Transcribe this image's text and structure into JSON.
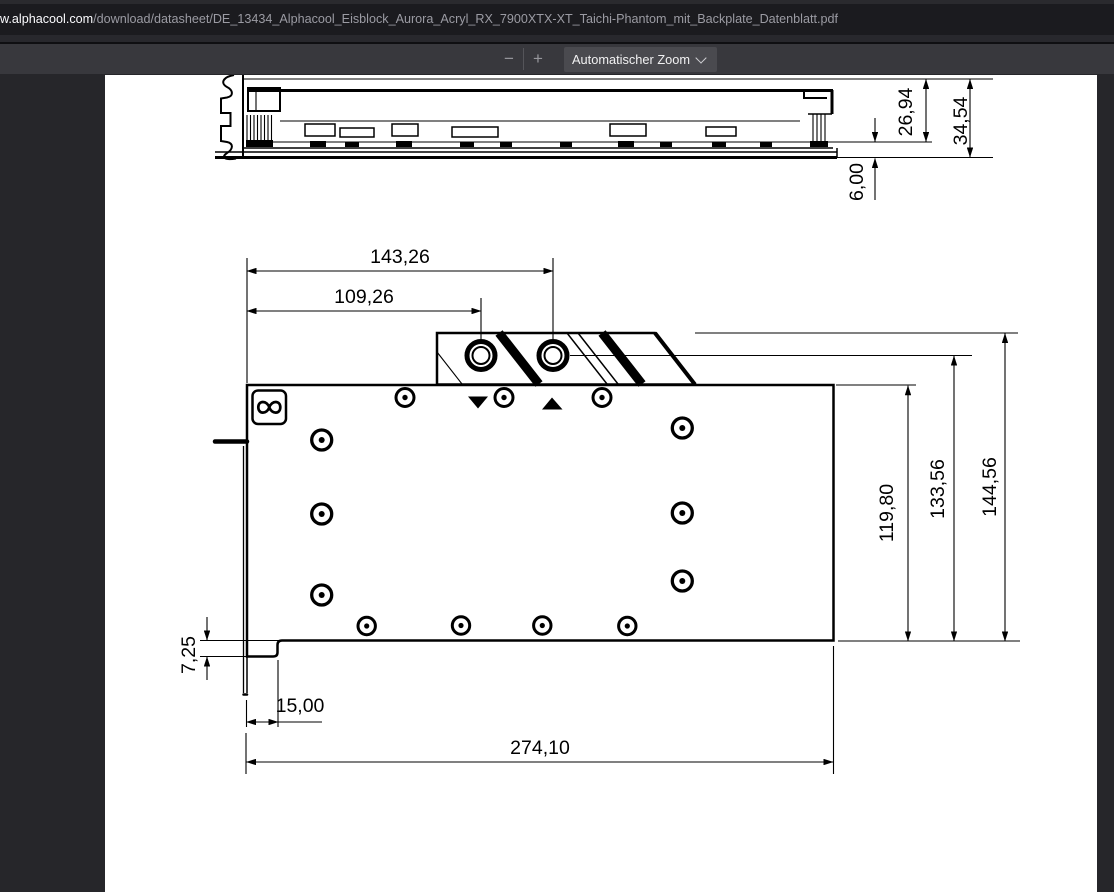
{
  "browser": {
    "address_bar": {
      "domain": "w.alphacool.com",
      "path": "/download/datasheet/DE_13434_Alphacool_Eisblock_Aurora_Acryl_RX_7900XTX-XT_Taichi-Phantom_mit_Backplate_Datenblatt.pdf"
    },
    "pdf_toolbar": {
      "zoom_out_label": "−",
      "zoom_in_label": "+",
      "zoom_select_value": "Automatischer Zoom"
    },
    "icons": {
      "zoom_select_chevron": "chevron-down"
    }
  },
  "colors": {
    "chrome_top": "#2a2a2e",
    "url_bar_bg": "#1b1b1f",
    "url_domain": "#fbfbfe",
    "url_path": "#9b9ba3",
    "toolbar_bg": "#38383d",
    "dropdown_bg": "#4a4a4f",
    "content_bg": "#26262a",
    "page_bg": "#ffffff",
    "drawing_line": "#000000"
  },
  "drawing": {
    "side_view": {
      "dim_upper_height": "26,94",
      "dim_total_height": "34,54",
      "dim_backplate": "6,00"
    },
    "front_view": {
      "dim_port2_x": "143,26",
      "dim_port1_x": "109,26",
      "dim_inner_height": "119,80",
      "dim_port_height": "133,56",
      "dim_total_height": "144,56",
      "dim_step_height": "7,25",
      "dim_step_width": "15,00",
      "dim_total_length": "274,10"
    }
  }
}
